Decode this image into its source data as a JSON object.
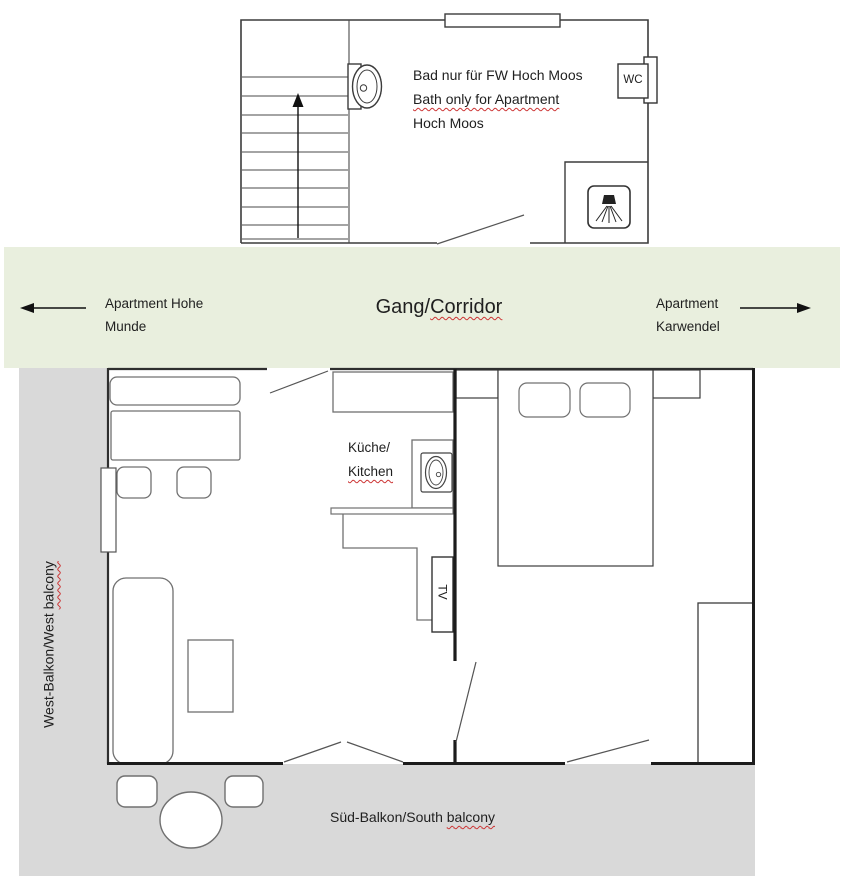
{
  "upper_floor": {
    "bath_note_line1": "Bad nur für FW Hoch Moos",
    "bath_note_line2": "Bath only for Apartment",
    "bath_note_line3": "Hoch Moos",
    "wc_label": "WC"
  },
  "corridor": {
    "left_apartment_line1": "Apartment Hohe",
    "left_apartment_line2": "Munde",
    "name_plain": "Gang/",
    "name_flagged": "Corridor",
    "right_apartment_line1": "Apartment",
    "right_apartment_line2": "Karwendel"
  },
  "apartment": {
    "kitchen_line1": "Küche/",
    "kitchen_line2": "Kitchen",
    "tv_label": "TV"
  },
  "balconies": {
    "west_plain": "West-Balkon/West",
    "west_flagged": "balcony",
    "south_plain": "Süd-Balkon/South",
    "south_flagged": "balcony"
  },
  "icons": [
    "stairs-up-arrow-icon",
    "sink-icon",
    "wc-icon",
    "shower-icon",
    "kitchen-sink-icon",
    "corridor-arrow-left-icon",
    "corridor-arrow-right-icon"
  ],
  "colors": {
    "corridor_bg": "#e9efde",
    "balcony_bg": "#d9d9d9",
    "wall_dark": "#1c1c1c",
    "wall": "#3a3a3a",
    "furniture_outline": "#707070",
    "spellcheck_squiggle": "#cc3333",
    "text": "#1f1f1f"
  }
}
